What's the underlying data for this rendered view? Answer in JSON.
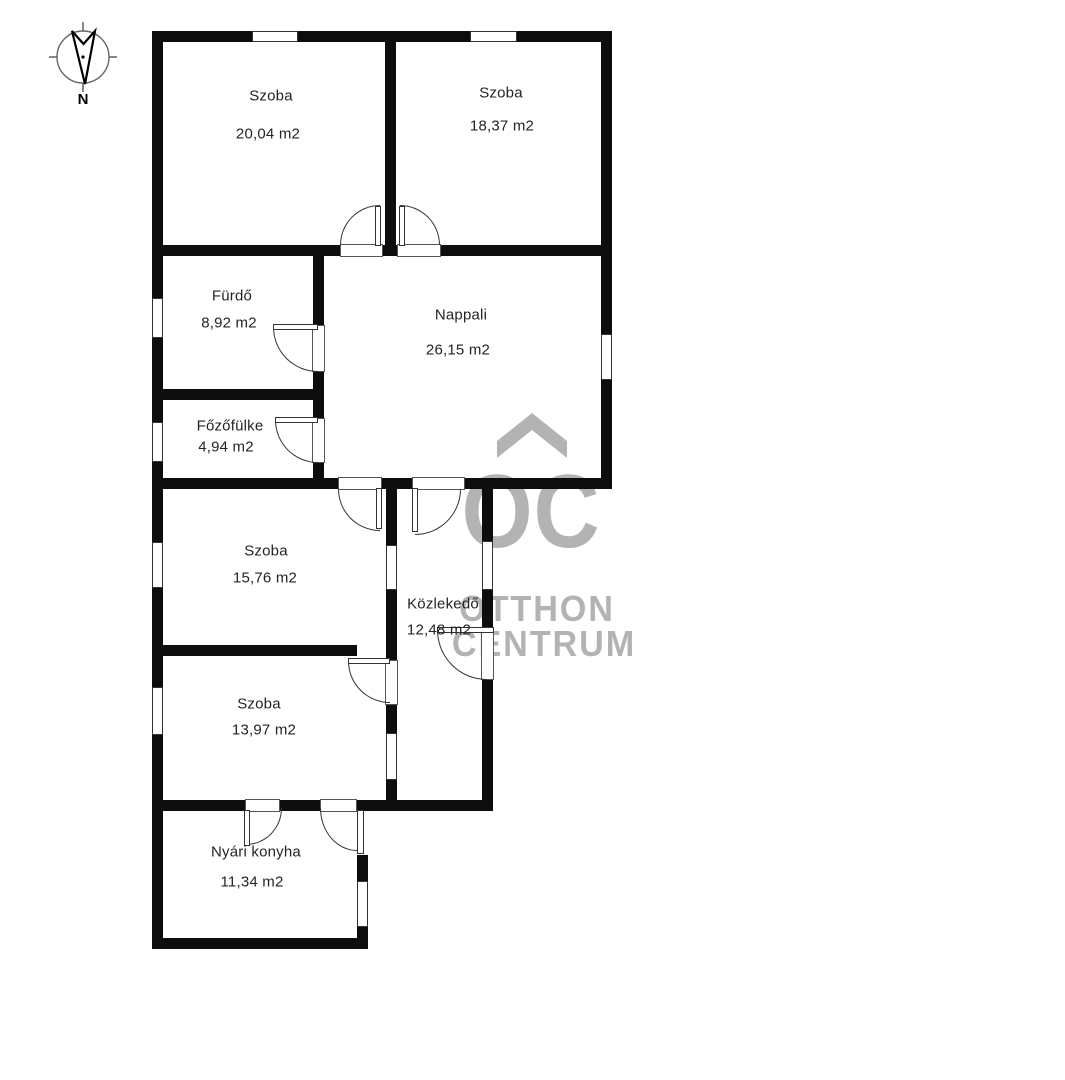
{
  "compass": {
    "north_label": "N"
  },
  "rooms": [
    {
      "id": "szoba-1",
      "name": "Szoba",
      "area": "20,04 m2"
    },
    {
      "id": "szoba-2",
      "name": "Szoba",
      "area": "18,37 m2"
    },
    {
      "id": "furdo",
      "name": "Fürdő",
      "area": "8,92 m2"
    },
    {
      "id": "nappali",
      "name": "Nappali",
      "area": "26,15 m2"
    },
    {
      "id": "fozofulke",
      "name": "Főzőfülke",
      "area": "4,94 m2"
    },
    {
      "id": "szoba-3",
      "name": "Szoba",
      "area": "15,76 m2"
    },
    {
      "id": "kozlekedo",
      "name": "Közlekedő",
      "area": "12,48 m2"
    },
    {
      "id": "szoba-4",
      "name": "Szoba",
      "area": "13,97 m2"
    },
    {
      "id": "nyari-konyha",
      "name": "Nyári konyha",
      "area": "11,34 m2"
    }
  ],
  "watermark": {
    "monogram": "OC",
    "line1": "OTTHON",
    "line2": "CENTRUM",
    "color": "#b3b3b3"
  },
  "colors": {
    "wall": "#0d0d0d",
    "background": "#ffffff",
    "label_text": "#242424"
  }
}
